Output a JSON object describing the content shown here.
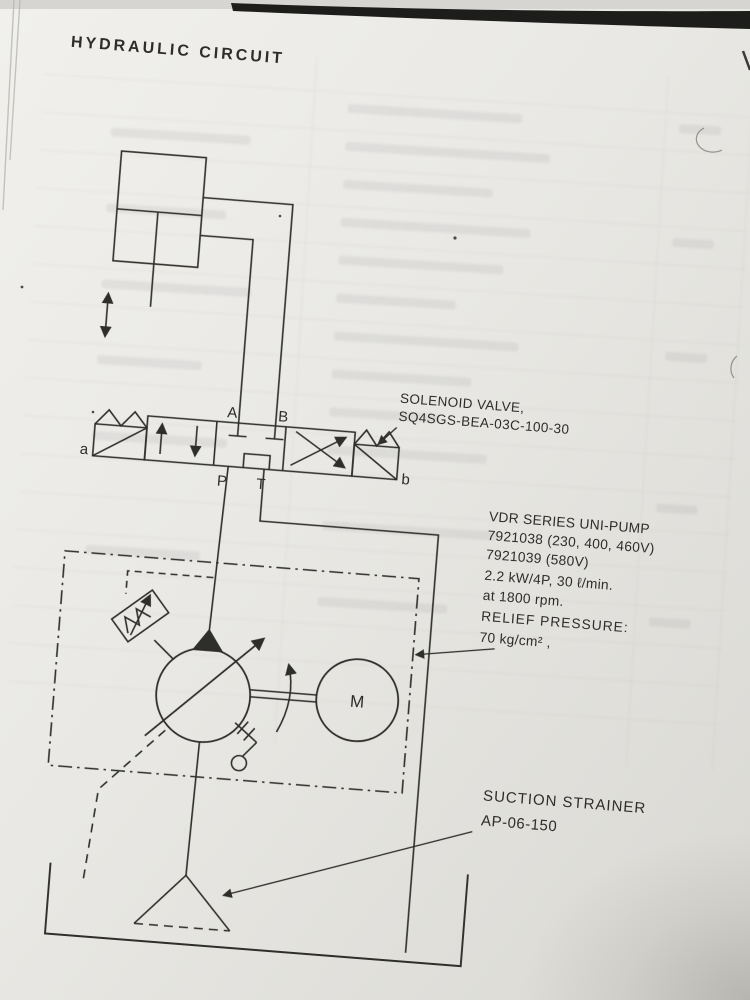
{
  "page": {
    "title": "HYDRAULIC CIRCUIT"
  },
  "valve": {
    "callout_line1": "SOLENOID VALVE,",
    "callout_line2": "SQ4SGS-BEA-03C-100-30",
    "port_a": "A",
    "port_b": "B",
    "port_p": "P",
    "port_t": "T",
    "solenoid_left": "a",
    "solenoid_right": "b"
  },
  "pump_unit": {
    "callout_lines": [
      "VDR SERIES UNI-PUMP",
      "7921038 (230, 400, 460V)",
      "7921039 (580V)",
      "2.2 kW/4P, 30 ℓ/min.",
      "at 1800 rpm.",
      "RELIEF PRESSURE:",
      "70 kg/cm² ,"
    ],
    "motor_label": "M"
  },
  "strainer": {
    "callout_line1": "SUCTION STRAINER",
    "callout_line2": "AP-06-150"
  },
  "colors": {
    "ink": "#2e2d2b",
    "paper": "#e9e8e4"
  }
}
